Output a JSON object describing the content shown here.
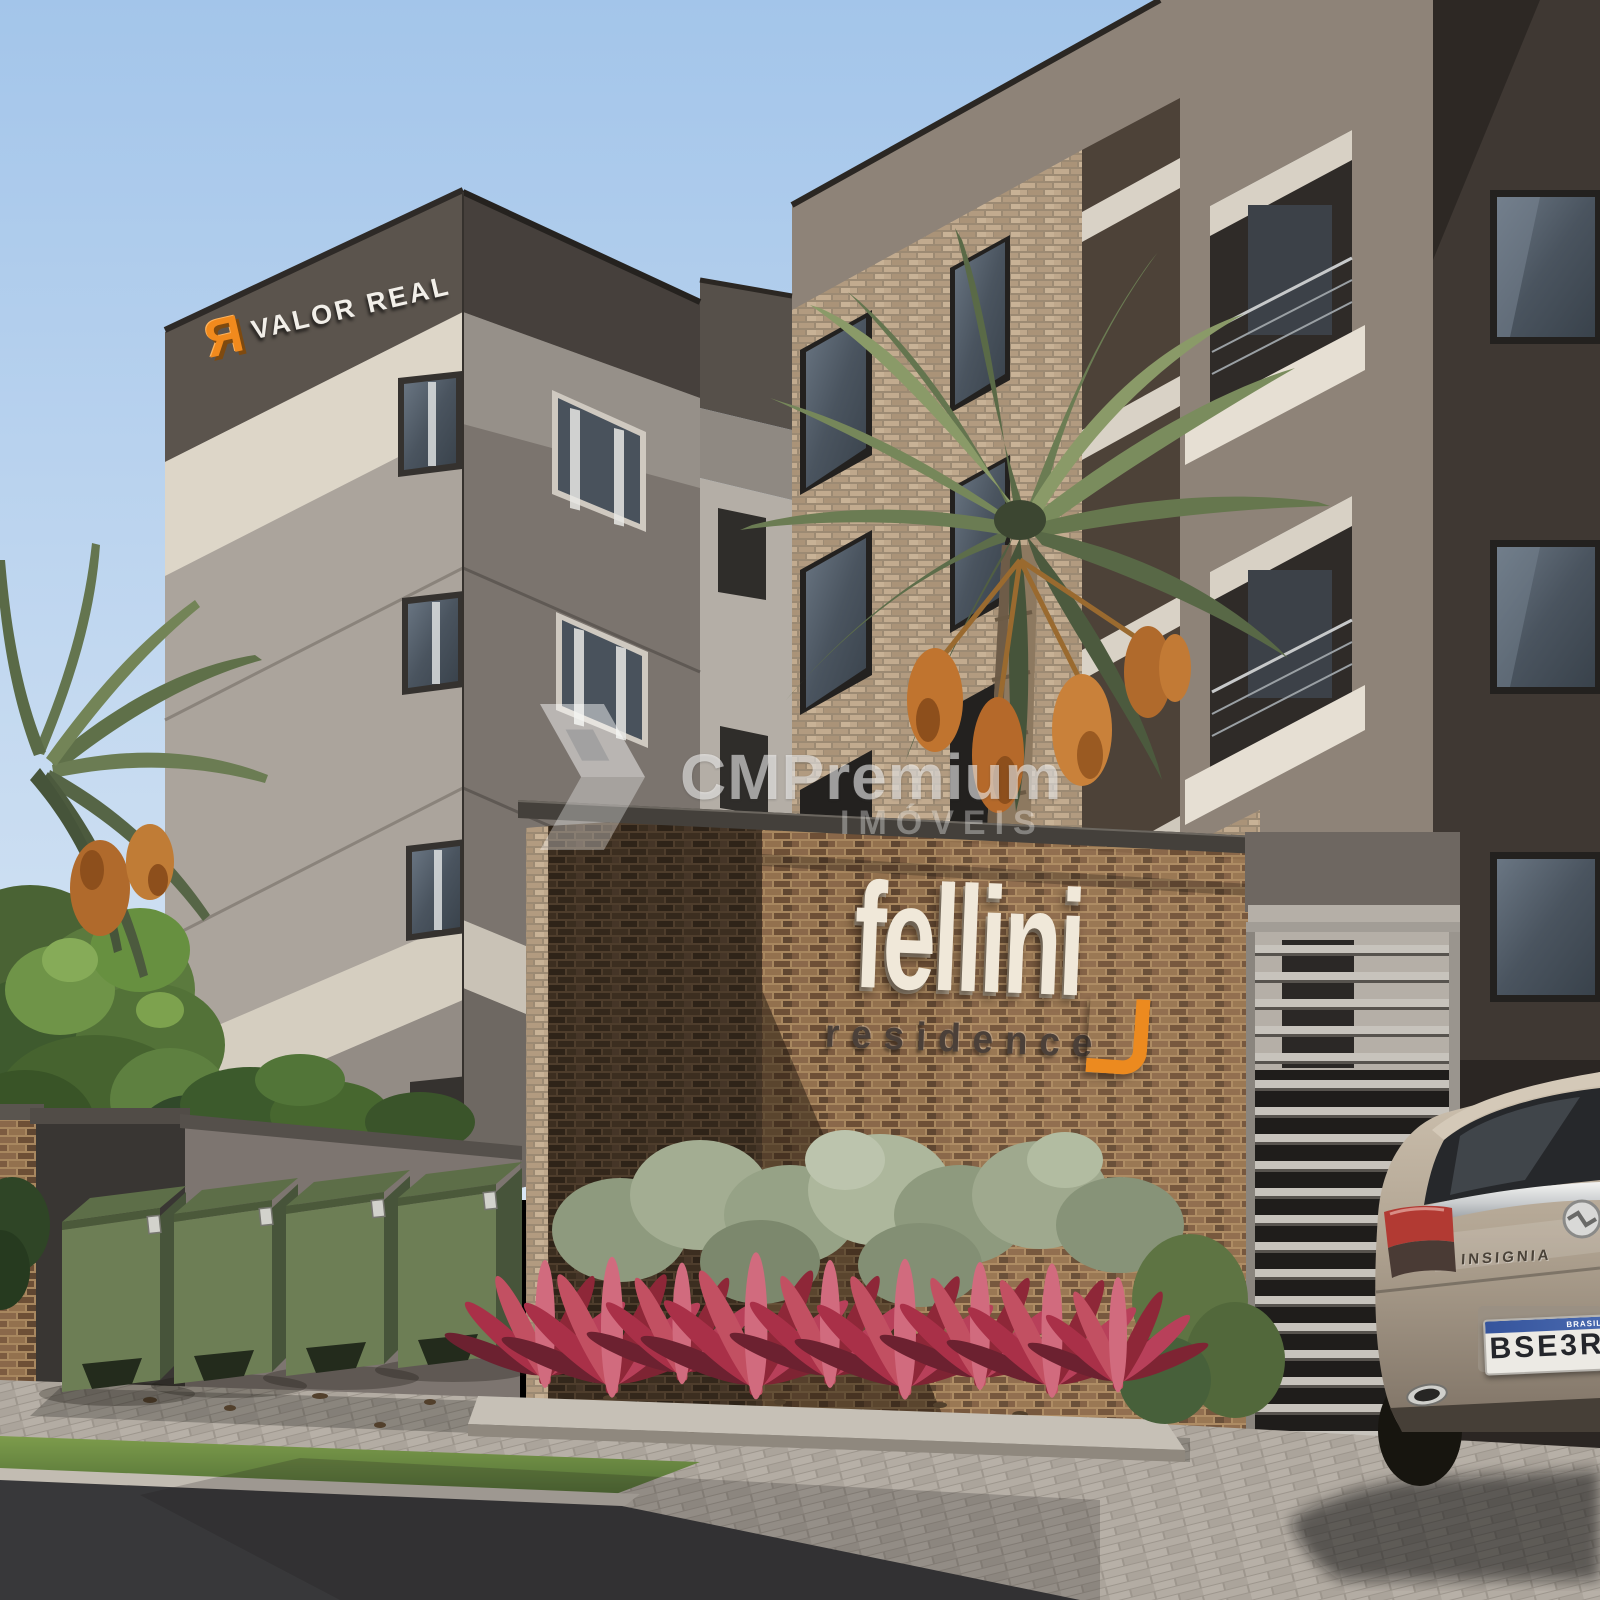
{
  "scene": {
    "title": "Fellini Residence — architectural exterior render",
    "description": "3D render of a four-storey apartment building with brick entrance wall, palm tree, recycling bins, metal gate and parked car"
  },
  "building_logo": {
    "icon_name": "valor-real-icon",
    "icon_glyph": "Я",
    "label": "VALOR REAL"
  },
  "watermark": {
    "icon_name": "cm-premium-arrow-icon",
    "brand": "CMPremium",
    "sub": "IMÓVEIS"
  },
  "entrance_sign": {
    "title": "fellini",
    "subtitle": "residence",
    "accent_icon": "orange-corner-bracket-icon"
  },
  "car": {
    "model_badge": "INSIGNIA",
    "plate_number": "BSE3R",
    "plate_country": "BRASIL"
  },
  "colors": {
    "sky_top": "#a3c5ea",
    "sky_horizon": "#d8e6f4",
    "accent_orange": "#ec8a1f",
    "sign_cream": "#f0e8d9",
    "facade_dark_taupe": "#564f49",
    "facade_light": "#aba49c",
    "band_cream": "#ddd6c8",
    "entry_brick": "#8a684a",
    "dumpster_green": "#6d7e55",
    "plant_red": "#a93048",
    "pavement": "#b0a9a0",
    "asphalt": "#38383a",
    "car_body": "#b4a795"
  }
}
